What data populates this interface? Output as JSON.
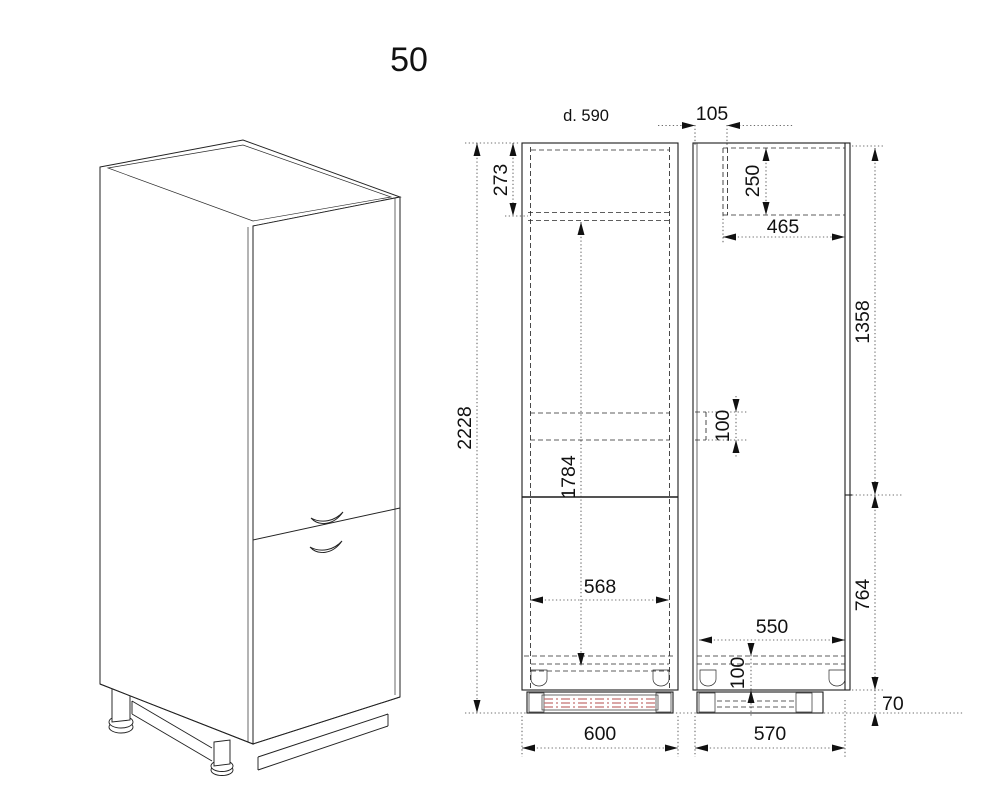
{
  "title": "50",
  "labels": {
    "depth_note": "d. 590"
  },
  "front_view": {
    "dims": {
      "total_height": "2228",
      "top_section_height": "273",
      "interior_height": "1784",
      "interior_width": "568",
      "overall_width": "600"
    }
  },
  "side_view": {
    "dims": {
      "front_recess_depth": "105",
      "top_recess_height": "250",
      "top_recess_depth": "465",
      "upper_section_height": "1358",
      "side_notch_height": "100",
      "interior_depth": "550",
      "bottom_shelf_height": "100",
      "lower_section_height": "764",
      "plinth_height": "70",
      "overall_depth": "570"
    }
  },
  "colors": {
    "line": "#1c1c1c",
    "hatch_red": "#c47272",
    "background": "#ffffff"
  }
}
